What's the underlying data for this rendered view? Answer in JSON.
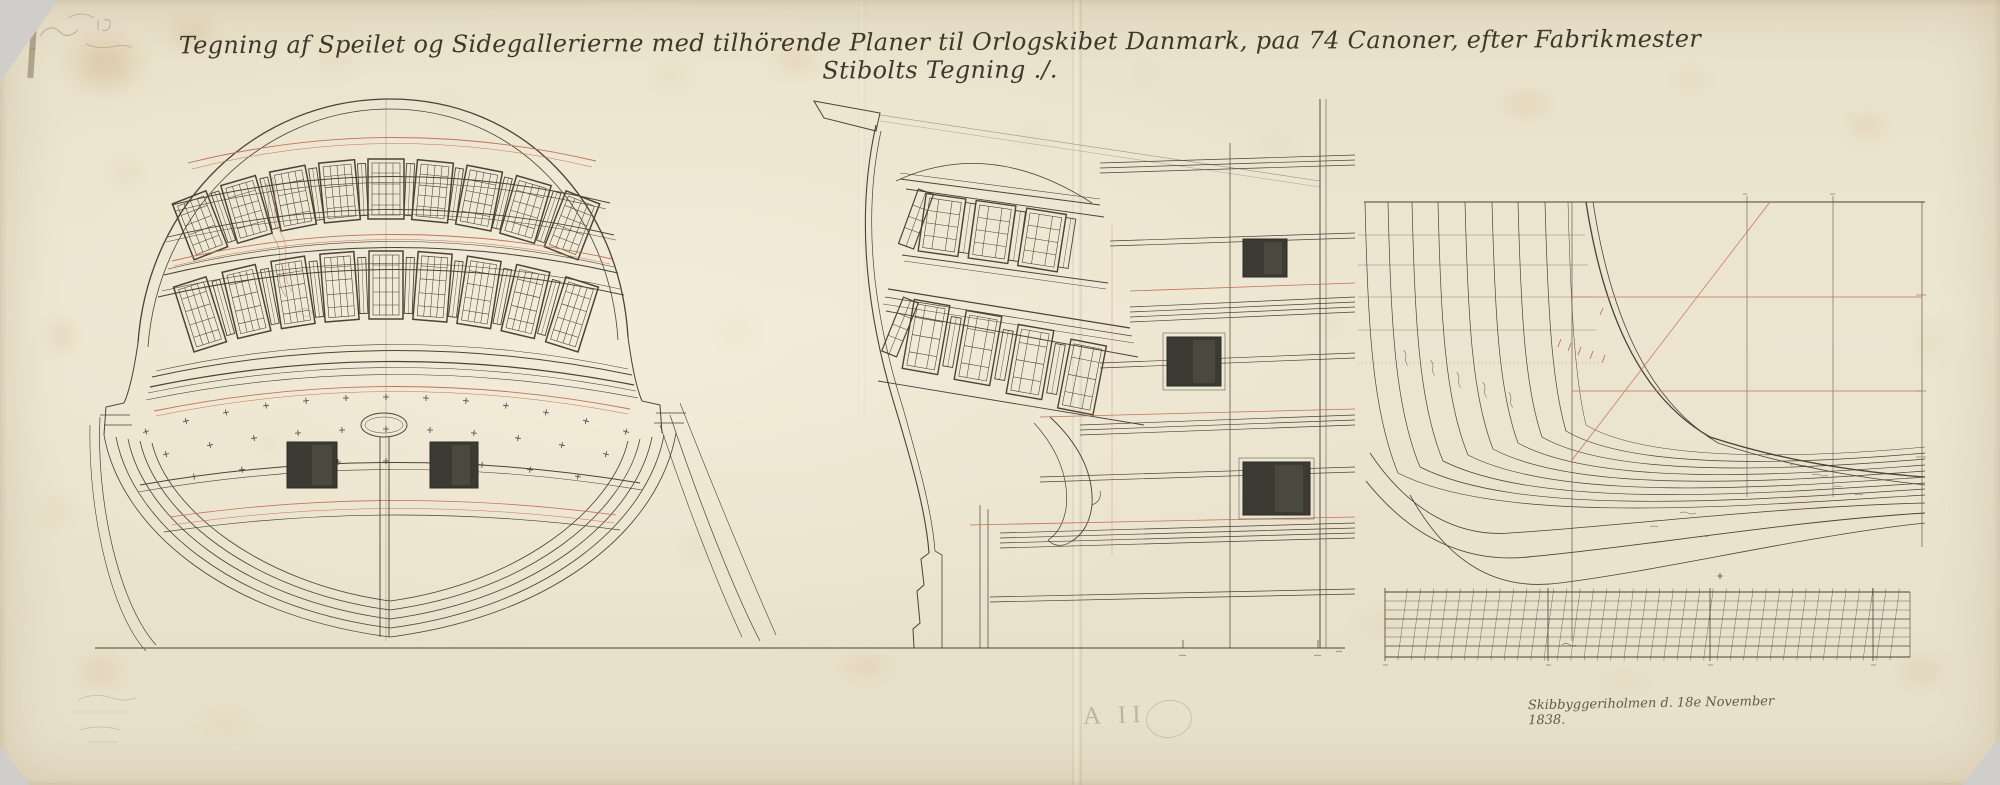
{
  "artwork": {
    "title": "Tegning af Speilet og Sidegallerierne med tilhörende Planer til Orlogskibet Danmark, paa 74 Canoner, efter Fabrikmester Stibolts Tegning ./.",
    "signature": "Skibbyggeriholmen d. 18e November 1838.",
    "stamp": "A II"
  },
  "colors": {
    "paper": "#ebe4cf",
    "ink": "#4b4336",
    "accent_red": "#c4705a",
    "stamp_grey": "#8a8574"
  }
}
